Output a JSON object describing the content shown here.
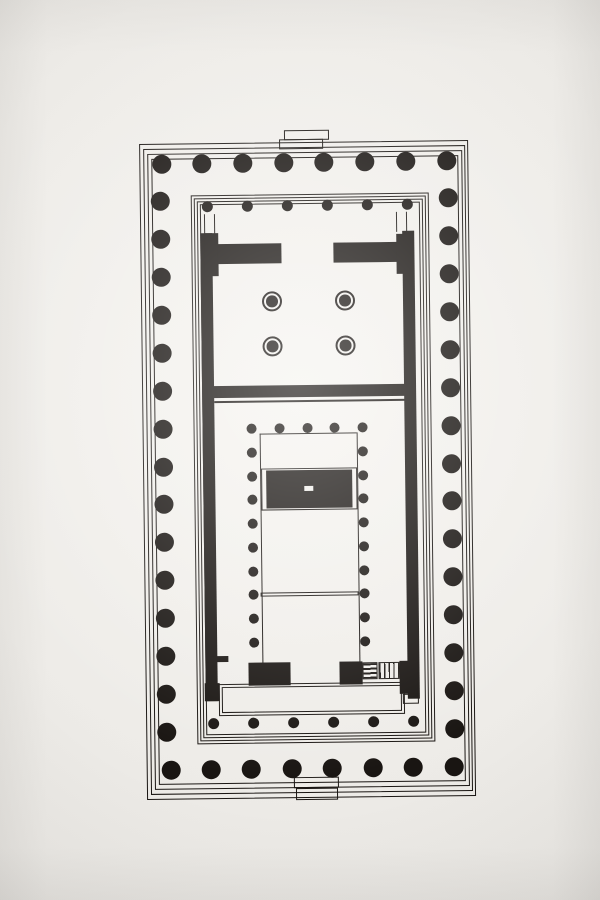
{
  "diagram": {
    "type": "architectural-floor-plan",
    "subject": "peripteral-temple-plan-parthenon-type",
    "colors": {
      "ink": "#191512",
      "paper": "#f2f0ec"
    },
    "plan_box": {
      "left": 143,
      "top": 128,
      "width": 330,
      "height": 672,
      "rotation_deg": -0.7
    },
    "summary": {
      "peristyle_columns": 46,
      "peristyle_grid": "8 x 17",
      "porch_columns_each_end": 6,
      "west_chamber_ring_columns": 4,
      "cella_interior_columns": 23
    }
  },
  "geometry": {
    "outline_groups": [
      {
        "name": "stylobate-step-outline",
        "stroke": 1.3,
        "rects": [
          [
            0,
            14,
            329,
            656
          ],
          [
            4,
            19,
            322,
            646
          ],
          [
            8,
            24,
            315,
            636
          ],
          [
            12,
            29,
            307,
            626
          ]
        ]
      },
      {
        "name": "inner-platform-step-outline",
        "stroke": 1,
        "rects": [
          [
            51,
            66,
            238,
            549
          ],
          [
            54,
            69,
            232,
            543
          ],
          [
            57,
            72,
            226,
            537
          ],
          [
            60,
            75,
            220,
            531
          ]
        ]
      },
      {
        "name": "north-ramp-outline",
        "stroke": 1.2,
        "rects": [
          [
            145,
            2,
            45,
            10
          ],
          [
            140,
            11,
            44,
            10
          ]
        ]
      },
      {
        "name": "south-ramp-outline",
        "stroke": 1.2,
        "rects": [
          [
            147,
            649,
            45,
            11
          ],
          [
            149,
            660,
            42,
            12
          ]
        ]
      },
      {
        "name": "east-porch-floor-outline",
        "stroke": 1,
        "rects": [
          [
            73,
            555,
            186,
            32
          ],
          [
            76,
            558,
            180,
            26
          ]
        ]
      },
      {
        "name": "statue-base-plinth-outline",
        "stroke": 1,
        "rects": [
          [
            118,
            340,
            96,
            42
          ]
        ]
      },
      {
        "name": "cella-cross-line",
        "stroke": 1,
        "rects": [
          [
            116,
            464,
            98,
            4
          ]
        ]
      },
      {
        "name": "stair-landing-outline",
        "stroke": 1,
        "rects": [
          [
            257,
            567,
            16,
            10
          ]
        ]
      }
    ],
    "filled_rects": [
      {
        "name": "cella-wall-left",
        "rect": [
          60,
          104,
          12,
          468
        ]
      },
      {
        "name": "cella-wall-right",
        "rect": [
          262,
          104,
          12,
          468
        ]
      },
      {
        "name": "west-anta-left",
        "rect": [
          64,
          104,
          14,
          43
        ]
      },
      {
        "name": "west-door-wall-left",
        "rect": [
          77,
          115,
          64,
          20
        ]
      },
      {
        "name": "west-door-wall-right",
        "rect": [
          193,
          115,
          64,
          20
        ]
      },
      {
        "name": "west-anta-right",
        "rect": [
          256,
          107,
          14,
          40
        ]
      },
      {
        "name": "cross-wall",
        "rect": [
          69,
          257,
          201,
          12
        ]
      },
      {
        "name": "cross-wall-ledge",
        "rect": [
          72,
          272,
          195,
          1.5
        ]
      },
      {
        "name": "cella-colonnade-line-left",
        "rect": [
          117,
          305,
          1.2,
          230
        ]
      },
      {
        "name": "cella-colonnade-line-right",
        "rect": [
          214,
          305,
          1.2,
          230
        ]
      },
      {
        "name": "cella-colonnade-line-top",
        "rect": [
          117,
          305,
          97,
          1.2
        ]
      },
      {
        "name": "statue-base",
        "rect": [
          123,
          342,
          86,
          38
        ]
      },
      {
        "name": "east-door-wall-left",
        "rect": [
          103,
          534,
          42,
          23
        ]
      },
      {
        "name": "east-door-wall-right",
        "rect": [
          194,
          534,
          23,
          23
        ]
      },
      {
        "name": "east-anta-left",
        "rect": [
          59,
          554,
          15,
          18
        ]
      },
      {
        "name": "east-wall-stub-left",
        "rect": [
          61,
          527,
          22,
          6
        ]
      },
      {
        "name": "east-anta-right",
        "rect": [
          254,
          534,
          18,
          33
        ]
      },
      {
        "name": "anta-step-line-a",
        "rect": [
          64,
          85,
          1,
          20
        ]
      },
      {
        "name": "anta-step-line-b",
        "rect": [
          74,
          85,
          1,
          20
        ]
      },
      {
        "name": "anta-step-line-c",
        "rect": [
          256,
          85,
          1,
          20
        ]
      },
      {
        "name": "anta-step-line-d",
        "rect": [
          266,
          85,
          1,
          20
        ]
      }
    ],
    "white_rects": [
      {
        "name": "statue-base-marker",
        "rect": [
          161,
          358,
          9,
          5
        ]
      }
    ],
    "hatched_rects": [
      {
        "name": "stairway-rungs",
        "rect": [
          217,
          535,
          15,
          17
        ],
        "pattern": "hrungs"
      },
      {
        "name": "stairway-hatch",
        "rect": [
          233,
          535,
          21,
          17
        ],
        "pattern": "vlines"
      }
    ],
    "circle_groups": [
      {
        "name": "peristyle-column",
        "r": 9.5,
        "centers": [
          [
            22,
            34
          ],
          [
            62.7,
            34
          ],
          [
            103.4,
            34
          ],
          [
            144.1,
            34
          ],
          [
            184.9,
            34
          ],
          [
            225.6,
            34
          ],
          [
            266.3,
            34
          ],
          [
            307,
            34
          ],
          [
            24,
            640
          ],
          [
            64.4,
            640
          ],
          [
            104.9,
            640
          ],
          [
            145.3,
            640
          ],
          [
            185.7,
            640
          ],
          [
            226.1,
            640
          ],
          [
            266.6,
            640
          ],
          [
            307,
            640
          ],
          [
            20,
            71.9
          ],
          [
            20,
            109.8
          ],
          [
            20,
            147.6
          ],
          [
            20,
            185.5
          ],
          [
            20,
            223.4
          ],
          [
            20,
            261.3
          ],
          [
            20,
            299.1
          ],
          [
            20,
            337
          ],
          [
            20,
            374.9
          ],
          [
            20,
            412.8
          ],
          [
            20,
            450.6
          ],
          [
            20,
            488.5
          ],
          [
            20,
            526.4
          ],
          [
            20,
            564.3
          ],
          [
            20,
            602.1
          ],
          [
            308,
            71.9
          ],
          [
            308,
            109.8
          ],
          [
            308,
            147.6
          ],
          [
            308,
            185.5
          ],
          [
            308,
            223.4
          ],
          [
            308,
            261.3
          ],
          [
            308,
            299.1
          ],
          [
            308,
            337
          ],
          [
            308,
            374.9
          ],
          [
            308,
            412.8
          ],
          [
            308,
            450.6
          ],
          [
            308,
            488.5
          ],
          [
            308,
            526.4
          ],
          [
            308,
            564.3
          ],
          [
            308,
            602.1
          ]
        ]
      },
      {
        "name": "porch-column",
        "r": 5.5,
        "centers": [
          [
            67,
            77
          ],
          [
            107,
            77
          ],
          [
            147,
            77
          ],
          [
            187,
            77
          ],
          [
            227,
            77
          ],
          [
            267,
            77
          ],
          [
            67,
            594
          ],
          [
            107,
            594
          ],
          [
            147,
            594
          ],
          [
            187,
            594
          ],
          [
            227,
            594
          ],
          [
            267,
            594
          ]
        ]
      },
      {
        "name": "cella-column",
        "r": 5,
        "centers": [
          [
            109,
            300
          ],
          [
            136.8,
            300
          ],
          [
            164.5,
            300
          ],
          [
            192.3,
            300
          ],
          [
            220,
            300
          ],
          [
            109,
            323.8
          ],
          [
            109,
            347.6
          ],
          [
            109,
            371.3
          ],
          [
            109,
            395.1
          ],
          [
            109,
            418.9
          ],
          [
            109,
            442.7
          ],
          [
            109,
            466.4
          ],
          [
            109,
            490.2
          ],
          [
            109,
            514
          ],
          [
            220,
            323.8
          ],
          [
            220,
            347.6
          ],
          [
            220,
            371.3
          ],
          [
            220,
            395.1
          ],
          [
            220,
            418.9
          ],
          [
            220,
            442.7
          ],
          [
            220,
            466.4
          ],
          [
            220,
            490.2
          ],
          [
            220,
            514
          ]
        ]
      }
    ],
    "ring_columns": {
      "name": "west-chamber-column-ring",
      "outer_r": 10,
      "stroke": 2.5,
      "inner_r": 5.8,
      "centers": [
        [
          131,
          173
        ],
        [
          204,
          173
        ],
        [
          131,
          218
        ],
        [
          204,
          218
        ]
      ]
    }
  }
}
